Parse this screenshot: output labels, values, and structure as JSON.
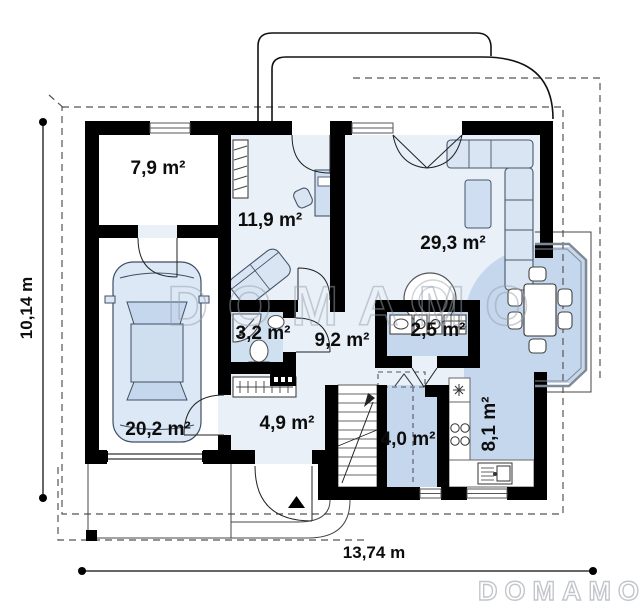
{
  "rooms": [
    {
      "key": "room-7-9",
      "label": "7,9 m²"
    },
    {
      "key": "room-11-9",
      "label": "11,9 m²"
    },
    {
      "key": "room-29-3",
      "label": "29,3 m²"
    },
    {
      "key": "room-3-2",
      "label": "3,2 m²"
    },
    {
      "key": "room-9-2",
      "label": "9,2 m²"
    },
    {
      "key": "room-2-5",
      "label": "2,5 m²"
    },
    {
      "key": "room-20-2",
      "label": "20,2 m²"
    },
    {
      "key": "room-4-9",
      "label": "4,9 m²"
    },
    {
      "key": "room-4-0",
      "label": "4,0 m²"
    },
    {
      "key": "room-8-1",
      "label": "8,1 m²"
    }
  ],
  "dimensions": {
    "height_label": "10,14 m",
    "width_label": "13,74 m"
  },
  "watermarks": {
    "center": "DOMAMO",
    "corner": "DOMAMO"
  },
  "colors": {
    "floor_light": "#eaf0f8",
    "floor_medium": "#c4d7ec",
    "floor_bath": "#cfe0f1",
    "wall": "#000000",
    "watermark": "#97a1ad"
  }
}
